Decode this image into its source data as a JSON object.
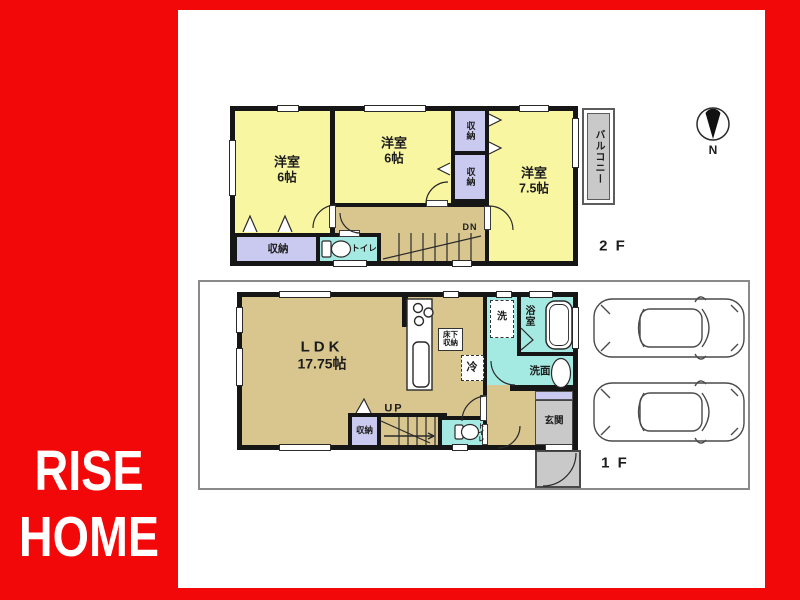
{
  "brand": {
    "line1": "RISE",
    "line2": "HOME"
  },
  "compass": {
    "north": "N"
  },
  "floor2": {
    "label": "2 F",
    "balcony": "バルコニー",
    "room_left": {
      "name": "洋室",
      "size": "6帖"
    },
    "room_middle": {
      "name": "洋室",
      "size": "6帖"
    },
    "room_right": {
      "name": "洋室",
      "size": "7.5帖"
    },
    "closet_top": "収納",
    "closet_middle": "収納",
    "closet_bottom": "収納",
    "toilet": "トイレ",
    "stairs_label": "DN"
  },
  "floor1": {
    "label": "1 F",
    "ldk_name": "LDK",
    "ldk_size": "17.75帖",
    "underfloor_storage": "床下収納",
    "fridge": "冷",
    "washer": "洗",
    "bath": "浴室",
    "vanity": "洗面",
    "toilet": "トイレ",
    "closet": "収納",
    "entrance": "玄関",
    "stairs_label": "UP"
  },
  "colors": {
    "accent_red": "#f20808",
    "room_yellow": "#f9f6a2",
    "floor_tan": "#d9c68f",
    "wet_cyan": "#a5eae2",
    "closet_lavender": "#cacaf0",
    "wall_black": "#161616",
    "gray": "#c9c9c9"
  }
}
